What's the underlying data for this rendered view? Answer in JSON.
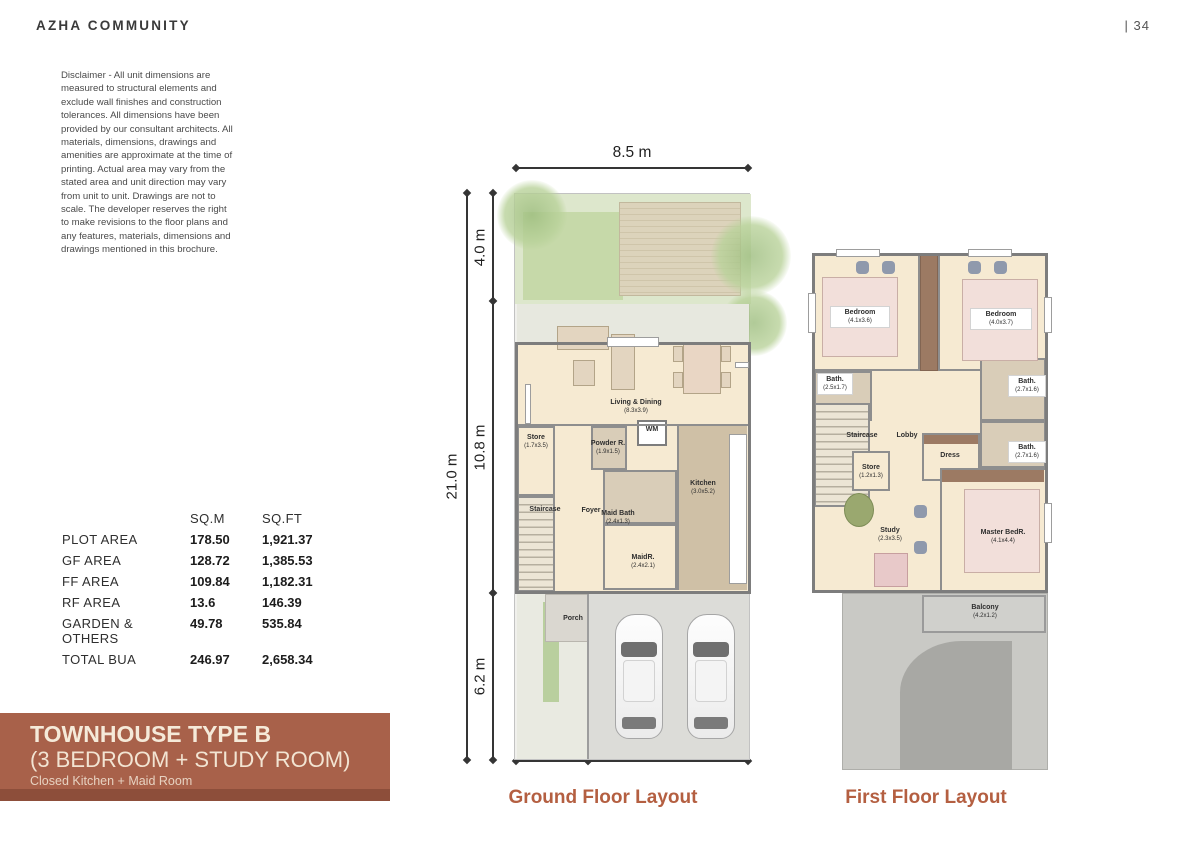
{
  "header": {
    "brand": "AZHA COMMUNITY",
    "page": "|  34"
  },
  "disclaimer": "Disclaimer - All unit dimensions are measured to structural elements and exclude wall finishes and construction tolerances. All dimensions have been provided by our consultant architects. All materials, dimensions, drawings and amenities are approximate at the time of printing. Actual area may vary from the stated area and unit direction may vary from unit to unit. Drawings are not to scale. The developer reserves the right to make revisions to the floor plans and any features, materials, dimensions and drawings mentioned in this brochure.",
  "areas": {
    "col_sqm": "SQ.M",
    "col_sqft": "SQ.FT",
    "rows": [
      {
        "label": "PLOT AREA",
        "sqm": "178.50",
        "sqft": "1,921.37"
      },
      {
        "label": "GF AREA",
        "sqm": "128.72",
        "sqft": "1,385.53"
      },
      {
        "label": "FF AREA",
        "sqm": "109.84",
        "sqft": "1,182.31"
      },
      {
        "label": "RF AREA",
        "sqm": "13.6",
        "sqft": "146.39"
      },
      {
        "label": "GARDEN & OTHERS",
        "sqm": "49.78",
        "sqft": "535.84"
      },
      {
        "label": "TOTAL BUA",
        "sqm": "246.97",
        "sqft": "2,658.34"
      }
    ]
  },
  "banner": {
    "title": "TOWNHOUSE TYPE B",
    "subtitle": "(3 BEDROOM + STUDY ROOM)",
    "tagline": "Closed Kitchen + Maid Room",
    "bg": "#a8614a"
  },
  "ground_floor": {
    "caption": "Ground Floor Layout",
    "dims": {
      "width": "8.5 m",
      "total": "21.0 m",
      "garden": "4.0 m",
      "house": "10.8 m",
      "drive": "6.2 m",
      "porch": "2.5 m",
      "garage": "5.5 m"
    },
    "rooms": {
      "living": {
        "name": "Living & Dining",
        "dims": "(8.3x3.9)"
      },
      "store": {
        "name": "Store",
        "dims": "(1.7x3.5)"
      },
      "staircase": {
        "name": "Staircase"
      },
      "foyer": {
        "name": "Foyer"
      },
      "powder": {
        "name": "Powder R.",
        "dims": "(1.9x1.5)"
      },
      "wm": {
        "name": "WM"
      },
      "maid_bath": {
        "name": "Maid Bath",
        "dims": "(2.4x1.3)"
      },
      "maid": {
        "name": "MaidR.",
        "dims": "(2.4x2.1)"
      },
      "kitchen": {
        "name": "Kitchen",
        "dims": "(3.0x5.2)"
      },
      "porch": {
        "name": "Porch"
      }
    }
  },
  "first_floor": {
    "caption": "First Floor Layout",
    "rooms": {
      "bedroom1": {
        "name": "Bedroom",
        "dims": "(4.1x3.6)"
      },
      "bedroom2": {
        "name": "Bedroom",
        "dims": "(4.0x3.7)"
      },
      "bath1": {
        "name": "Bath.",
        "dims": "(2.5x1.7)"
      },
      "bath2": {
        "name": "Bath.",
        "dims": "(2.7x1.6)"
      },
      "bath3": {
        "name": "Bath.",
        "dims": "(2.7x1.6)"
      },
      "staircase": {
        "name": "Staircase"
      },
      "lobby": {
        "name": "Lobby"
      },
      "store": {
        "name": "Store",
        "dims": "(1.2x1.3)"
      },
      "dress": {
        "name": "Dress"
      },
      "study": {
        "name": "Study",
        "dims": "(2.3x3.5)"
      },
      "master": {
        "name": "Master BedR.",
        "dims": "(4.1x4.4)"
      },
      "balcony": {
        "name": "Balcony",
        "dims": "(4.2x1.2)"
      }
    }
  }
}
